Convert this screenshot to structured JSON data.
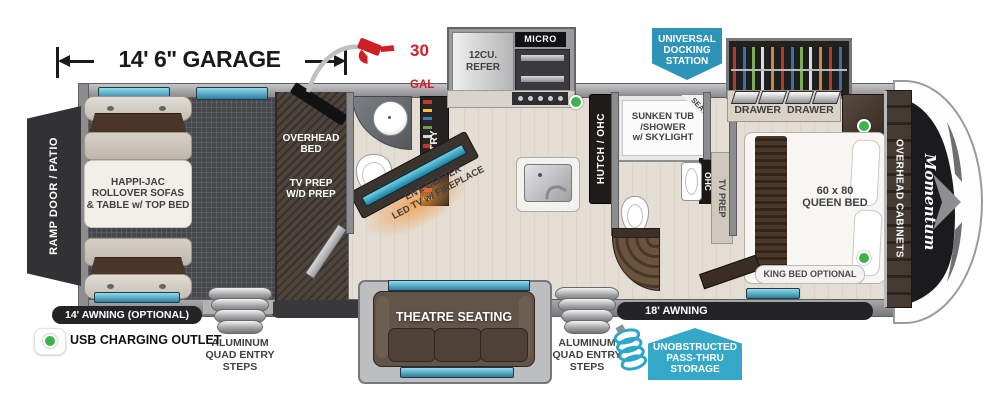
{
  "dimension": {
    "garage_length": "14' 6\" GARAGE"
  },
  "fuel": {
    "amount": "30",
    "unit": "GAL"
  },
  "garage": {
    "ramp_door": "RAMP DOOR / PATIO",
    "sofa_label": "HAPPI-JAC\nROLLOVER SOFAS\n& TABLE w/ TOP BED",
    "overhead_bed": "OVERHEAD\nBED",
    "tv_wd_prep": "TV PREP\nW/D PREP",
    "awning": "14' AWNING (OPTIONAL)",
    "steps": "ALUMINUM\nQUAD ENTRY\nSTEPS"
  },
  "kitchen": {
    "pantry": "PANTRY",
    "refer": "12CU.\nREFER",
    "micro": "MICRO",
    "ent_center": "ENT. CENTER\nLED TV w/ FIREPLACE",
    "hutch": "HUTCH / OHC"
  },
  "bath": {
    "tub": "SUNKEN TUB\n/SHOWER\nw/ SKYLIGHT",
    "seat": "SEAT",
    "ohc": "OHC"
  },
  "hall": {
    "tv_prep": "TV PREP"
  },
  "bedroom": {
    "drawer_left": "DRAWER",
    "drawer_right": "DRAWER",
    "bed": "60 x 80\nQUEEN BED",
    "king_option": "KING BED OPTIONAL",
    "overhead_cabinets": "OVERHEAD CABINETS",
    "logo": "Momentum"
  },
  "exterior": {
    "awning_18": "18' AWNING",
    "steps": "ALUMINUM\nQUAD ENTRY\nSTEPS",
    "theatre": "THEATRE SEATING"
  },
  "badges": {
    "docking_station": "UNIVERSAL\nDOCKING\nSTATION",
    "pass_thru": "UNOBSTRUCTED\nPASS-THRU\nSTORAGE"
  },
  "legend": {
    "charging_outlet": "USB CHARGING OUTLET"
  },
  "colors": {
    "accent_teal": "#35a8c8",
    "badge_blue": "#2e93b8",
    "fuel_red": "#d01f26",
    "outlet_green": "#3bb54a"
  }
}
